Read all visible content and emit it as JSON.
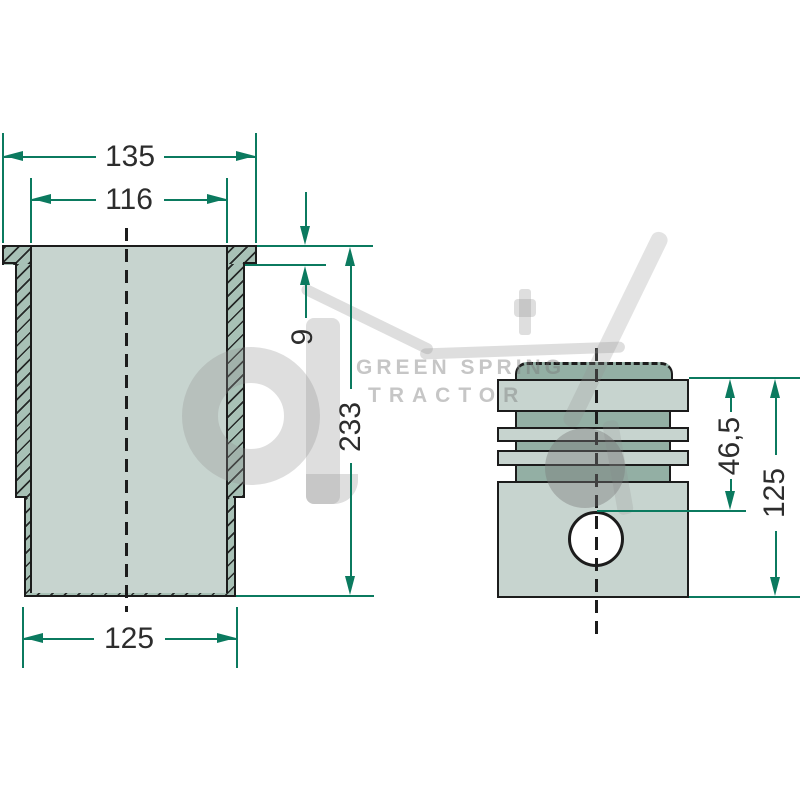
{
  "drawing": {
    "title_hint": "cylinder liner and piston cross-section drawing",
    "liner": {
      "dim_top_outer_diameter": "135",
      "dim_bore_diameter": "116",
      "dim_flange_height": "9",
      "dim_total_height": "233",
      "dim_bottom_diameter": "125"
    },
    "piston": {
      "dim_compression_height": "46,5",
      "dim_total_height": "125"
    }
  },
  "watermark": {
    "line1": "GREEN SPRING",
    "line2": "TRACTOR"
  },
  "colors": {
    "dim": "#0b7a5f",
    "outline": "#1c1c1c",
    "fill_light": "#c7d4cf",
    "fill_dark": "#93afa4",
    "wall": "#a8c1b6",
    "text": "#2d2d2d"
  }
}
